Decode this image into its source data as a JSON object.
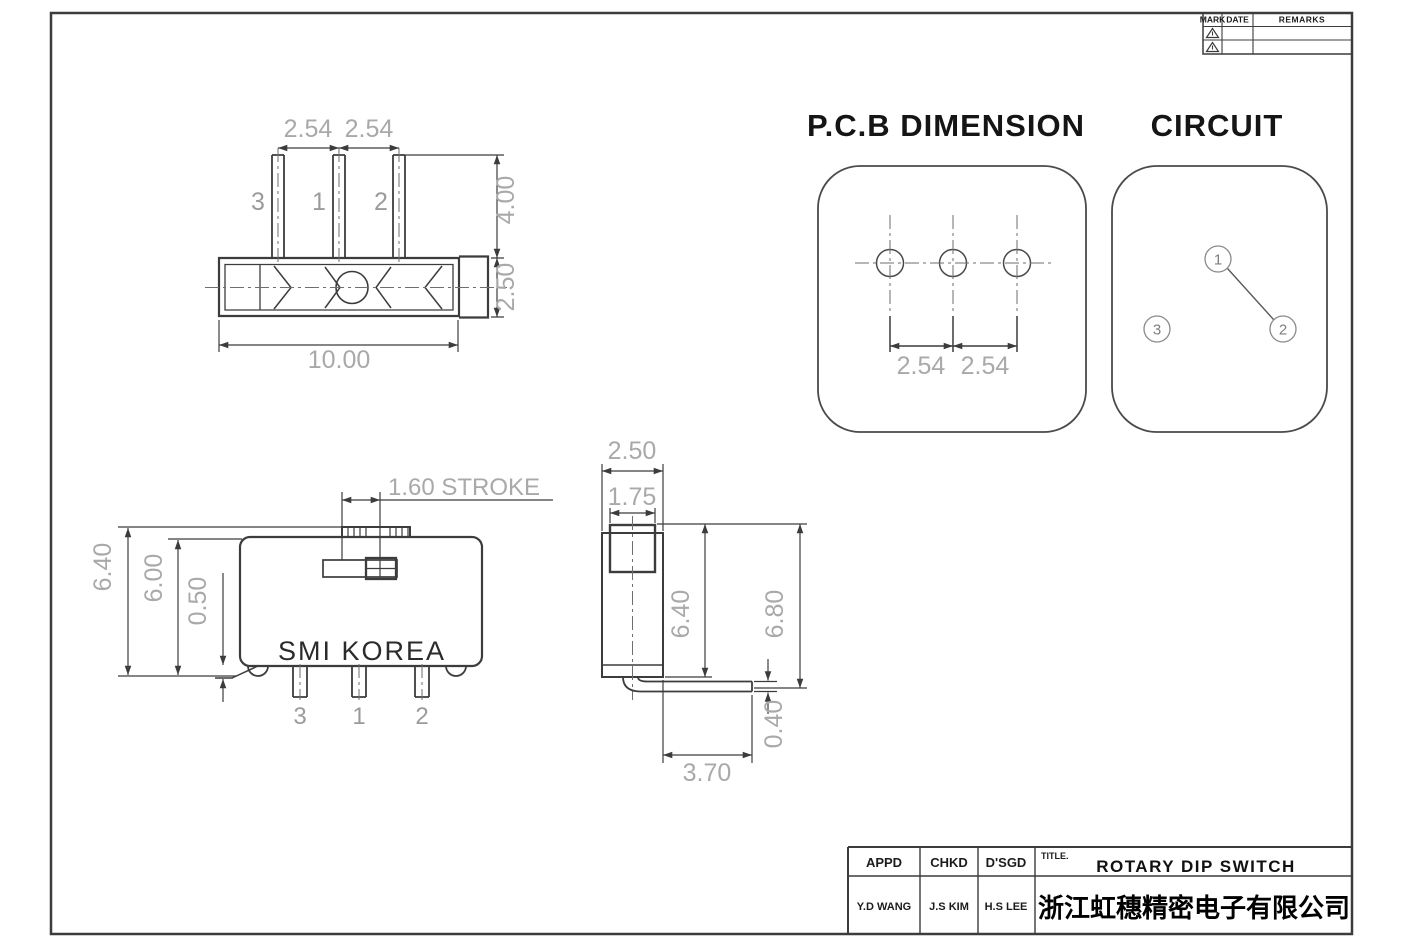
{
  "rev_table": {
    "headers": [
      "MARK",
      "DATE",
      "REMARKS"
    ]
  },
  "icons": {
    "revision_marker": "warning-triangle"
  },
  "top_view": {
    "pitch_left": "2.54",
    "pitch_right": "2.54",
    "pin_labels": [
      "3",
      "1",
      "2"
    ],
    "pin_height": "4.00",
    "body_thickness": "2.50",
    "body_width": "10.00"
  },
  "pcb": {
    "title": "P.C.B DIMENSION",
    "pitch_left": "2.54",
    "pitch_right": "2.54"
  },
  "circuit": {
    "title": "CIRCUIT",
    "t1": "1",
    "t2": "2",
    "t3": "3"
  },
  "front_view": {
    "stroke": "1.60 STROKE",
    "total_height": "6.40",
    "body_height": "6.00",
    "standoff": "0.50",
    "brand": "SMI KOREA",
    "pin_labels": [
      "3",
      "1",
      "2"
    ]
  },
  "side_view": {
    "body_width": "2.50",
    "knob_width": "1.75",
    "height": "6.40",
    "total_height": "6.80",
    "pin_thickness": "0.40",
    "pin_length": "3.70"
  },
  "title_block": {
    "appd_label": "APPD",
    "chkd_label": "CHKD",
    "dsgd_label": "D'SGD",
    "title_label": "TITLE.",
    "title": "ROTARY DIP SWITCH",
    "appd": "Y.D WANG",
    "chkd": "J.S KIM",
    "dsgd": "H.S LEE",
    "company": "浙江虹穗精密电子有限公司"
  },
  "colors": {
    "line": "#3c3c3c",
    "dim_text": "#a9a9a9",
    "title_text": "#151515"
  }
}
